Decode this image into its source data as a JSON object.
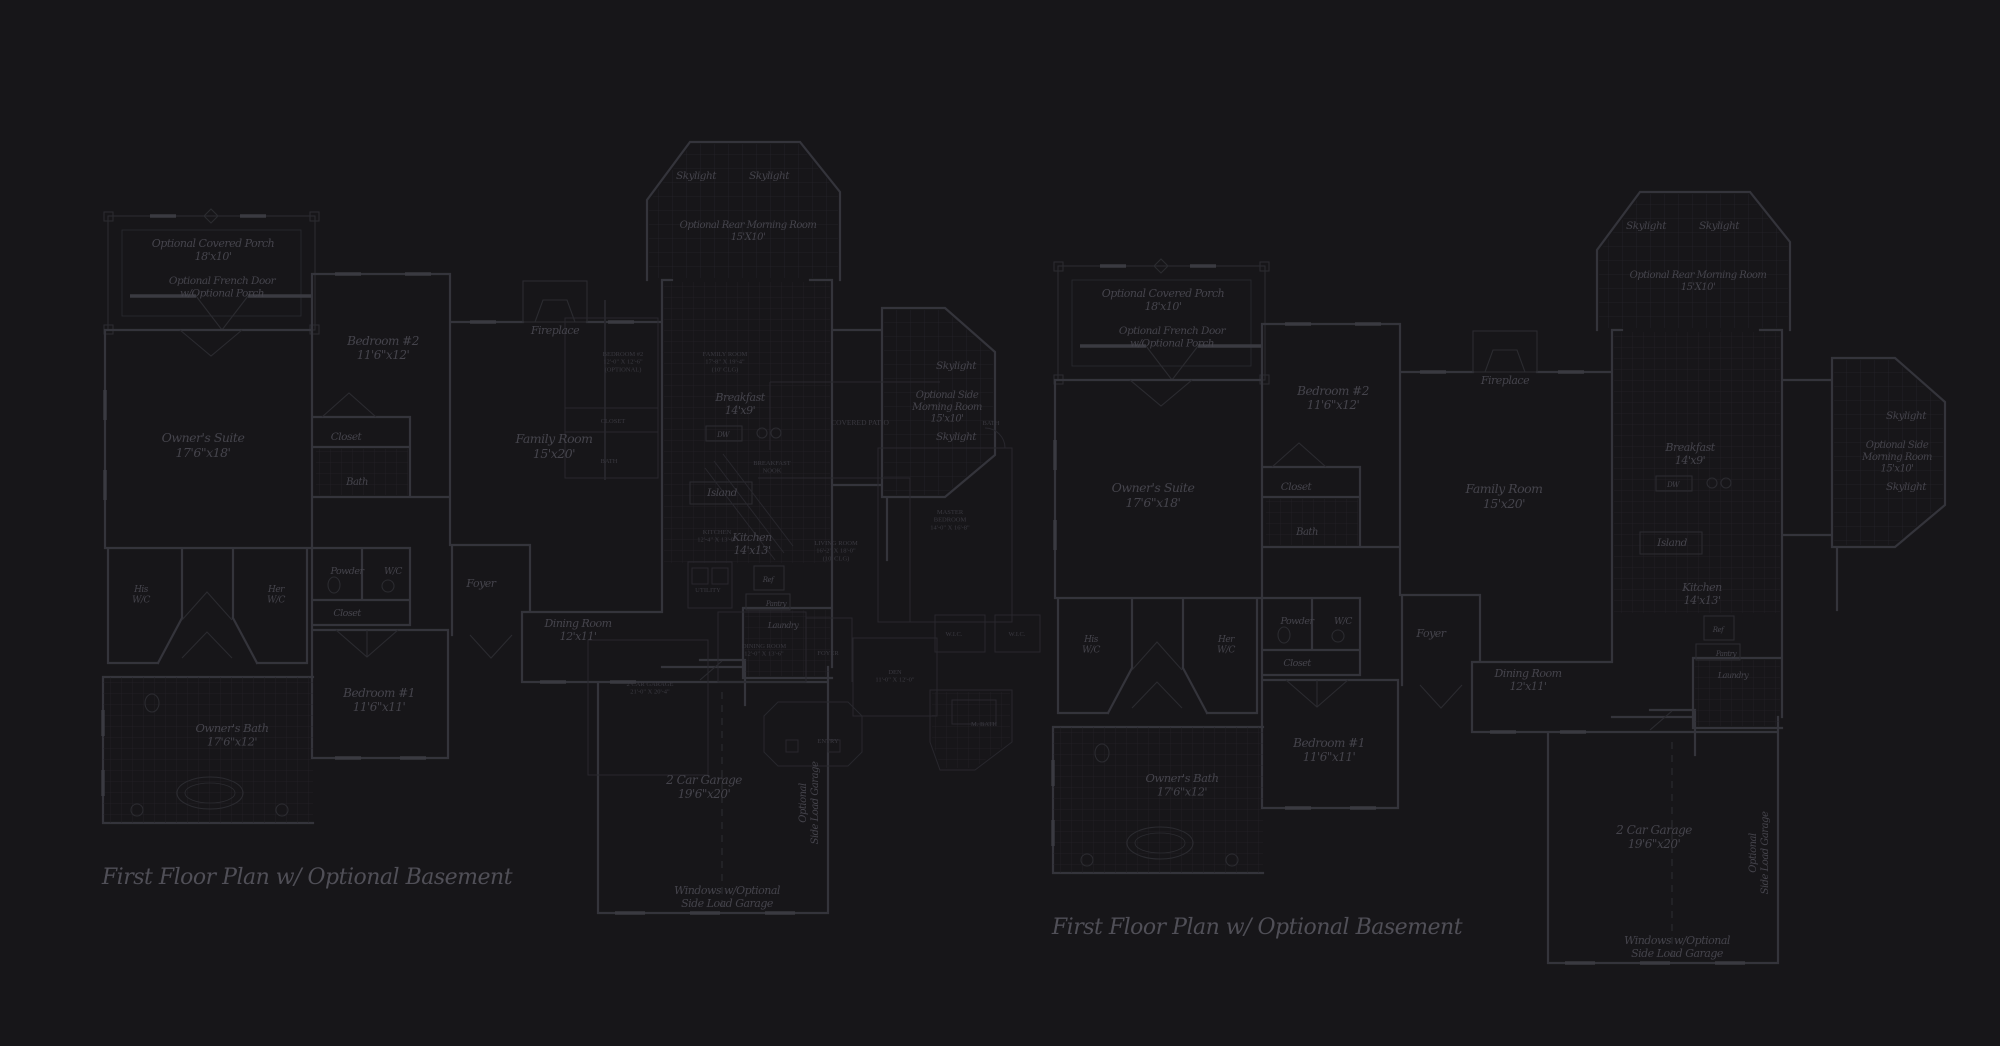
{
  "palette": {
    "background": "#171619",
    "wall": "#34343b",
    "wall_light": "#2b2b30",
    "grid": "#222126",
    "grid2": "#242329",
    "hatch": "#2f2e34",
    "label": "#45444c",
    "overlay_text": "#3a3940",
    "overlay_line": "#28272d",
    "caption": "#504f57",
    "tick": "#3a3a41"
  },
  "right_instance_offset": {
    "dx": 950,
    "dy": 50
  },
  "base_plan": {
    "caption": "First Floor Plan  w/ Optional Basement",
    "labels": [
      {
        "name": "porch-label",
        "lines": [
          "Optional Covered Porch",
          "18'x10'"
        ],
        "x": 213,
        "y": 247,
        "fs": 11
      },
      {
        "name": "french-door-label",
        "lines": [
          "Optional French Door",
          "w/Optional Porch"
        ],
        "x": 222,
        "y": 284,
        "fs": 10.5
      },
      {
        "name": "bedroom2-label",
        "lines": [
          "Bedroom #2",
          "11'6\"x12'"
        ],
        "x": 383,
        "y": 345,
        "fs": 12
      },
      {
        "name": "owners-suite-label",
        "lines": [
          "Owner's Suite",
          "17'6\"x18'"
        ],
        "x": 203,
        "y": 442,
        "fs": 12.5
      },
      {
        "name": "closet-bedroom2-label",
        "lines": [
          "Closet"
        ],
        "x": 346,
        "y": 440,
        "fs": 10.5
      },
      {
        "name": "bath-bedroom2-label",
        "lines": [
          "Bath"
        ],
        "x": 357,
        "y": 485,
        "fs": 10
      },
      {
        "name": "fireplace-label",
        "lines": [
          "Fireplace"
        ],
        "x": 555,
        "y": 334,
        "fs": 11
      },
      {
        "name": "skylight-rear-left-label",
        "lines": [
          "Skylight"
        ],
        "x": 696,
        "y": 179,
        "fs": 10.5
      },
      {
        "name": "skylight-rear-right-label",
        "lines": [
          "Skylight"
        ],
        "x": 769,
        "y": 179,
        "fs": 10.5
      },
      {
        "name": "rear-morning-room-label",
        "lines": [
          "Optional Rear Morning Room",
          "15'X10'"
        ],
        "x": 748,
        "y": 228,
        "fs": 10
      },
      {
        "name": "family-room-label",
        "lines": [
          "Family Room",
          "15'x20'"
        ],
        "x": 554,
        "y": 443,
        "fs": 12.5
      },
      {
        "name": "breakfast-label",
        "lines": [
          "Breakfast",
          "14'x9'"
        ],
        "x": 740,
        "y": 401,
        "fs": 11
      },
      {
        "name": "dw-label",
        "lines": [
          "DW"
        ],
        "x": 723,
        "y": 437,
        "fs": 7
      },
      {
        "name": "island-label",
        "lines": [
          "Island"
        ],
        "x": 722,
        "y": 496,
        "fs": 10.5
      },
      {
        "name": "kitchen-label",
        "lines": [
          "Kitchen",
          "14'x13'"
        ],
        "x": 752,
        "y": 541,
        "fs": 11
      },
      {
        "name": "ref-label",
        "lines": [
          "Ref"
        ],
        "x": 768,
        "y": 582,
        "fs": 7
      },
      {
        "name": "pantry-label",
        "lines": [
          "Pantry"
        ],
        "x": 776,
        "y": 606,
        "fs": 7
      },
      {
        "name": "laundry-label",
        "lines": [
          "Laundry"
        ],
        "x": 783,
        "y": 628,
        "fs": 8
      },
      {
        "name": "skylight-side-top-label",
        "lines": [
          "Skylight"
        ],
        "x": 956,
        "y": 369,
        "fs": 10.5
      },
      {
        "name": "side-morning-room-label",
        "lines": [
          "Optional Side",
          "Morning Room",
          "15'x10'"
        ],
        "x": 947,
        "y": 398,
        "fs": 10
      },
      {
        "name": "skylight-side-bottom-label",
        "lines": [
          "Skylight"
        ],
        "x": 956,
        "y": 440,
        "fs": 10.5
      },
      {
        "name": "his-wc-label",
        "lines": [
          "His",
          "W/C"
        ],
        "x": 141,
        "y": 592,
        "fs": 9
      },
      {
        "name": "her-wc-label",
        "lines": [
          "Her",
          "W/C"
        ],
        "x": 276,
        "y": 592,
        "fs": 9
      },
      {
        "name": "powder-label",
        "lines": [
          "Powder"
        ],
        "x": 347,
        "y": 574,
        "fs": 9.5
      },
      {
        "name": "wc-label",
        "lines": [
          "W/C"
        ],
        "x": 393,
        "y": 574,
        "fs": 9
      },
      {
        "name": "foyer-label",
        "lines": [
          "Foyer"
        ],
        "x": 481,
        "y": 587,
        "fs": 11
      },
      {
        "name": "closet-hall-label",
        "lines": [
          "Closet"
        ],
        "x": 347,
        "y": 616,
        "fs": 9.5
      },
      {
        "name": "dining-room-label",
        "lines": [
          "Dining Room",
          "12'x11'"
        ],
        "x": 578,
        "y": 627,
        "fs": 11
      },
      {
        "name": "bedroom1-label",
        "lines": [
          "Bedroom #1",
          "11'6\"x11'"
        ],
        "x": 379,
        "y": 697,
        "fs": 12
      },
      {
        "name": "owners-bath-label",
        "lines": [
          "Owner's Bath",
          "17'6\"x12'"
        ],
        "x": 232,
        "y": 732,
        "fs": 11.5
      },
      {
        "name": "garage-label",
        "lines": [
          "2 Car Garage",
          "19'6\"x20'"
        ],
        "x": 704,
        "y": 784,
        "fs": 12
      },
      {
        "name": "side-load-garage-label",
        "lines": [
          "Optional",
          "Side Load Garage"
        ],
        "x": 806,
        "y": 803,
        "fs": 10,
        "rot": -90
      },
      {
        "name": "windows-note-label",
        "lines": [
          "Windows w/Optional",
          "Side Load Garage"
        ],
        "x": 727,
        "y": 894,
        "fs": 11
      },
      {
        "name": "plan-caption",
        "lines": [
          "First Floor Plan  w/ Optional Basement"
        ],
        "x": 307,
        "y": 884,
        "fs": 22,
        "fill": "caption",
        "ls": -1
      }
    ]
  },
  "overlay_plan": {
    "labels": [
      {
        "name": "ovl-bedroom-label",
        "lines": [
          "BEDROOM #2",
          "12'-0\" X 12'-6\"",
          "(OPTIONAL)"
        ],
        "x": 623,
        "y": 356
      },
      {
        "name": "ovl-family-room-label",
        "lines": [
          "FAMILY ROOM",
          "17'-8\" X 19'-4\"",
          "(10' CLG)"
        ],
        "x": 725,
        "y": 356
      },
      {
        "name": "ovl-closet-label",
        "lines": [
          "CLOSET"
        ],
        "x": 613,
        "y": 423
      },
      {
        "name": "ovl-bath-label",
        "lines": [
          "BATH"
        ],
        "x": 609,
        "y": 463
      },
      {
        "name": "ovl-covered-patio-label",
        "lines": [
          "COVERED PATIO"
        ],
        "x": 860,
        "y": 425,
        "fs": 7.5
      },
      {
        "name": "ovl-breakfast-nook-label",
        "lines": [
          "BREAKFAST",
          "NOOK"
        ],
        "x": 772,
        "y": 465
      },
      {
        "name": "ovl-kitchen-label",
        "lines": [
          "KITCHEN",
          "12'-4\" X 13'-0\""
        ],
        "x": 717,
        "y": 534
      },
      {
        "name": "ovl-living-room-label",
        "lines": [
          "LIVING ROOM",
          "16'-2\" X 18'-0\"",
          "(10' CLG)"
        ],
        "x": 836,
        "y": 545
      },
      {
        "name": "ovl-master-bedroom-label",
        "lines": [
          "MASTER",
          "BEDROOM",
          "14'-0\" X 16'-8\""
        ],
        "x": 950,
        "y": 514
      },
      {
        "name": "ovl-master-bath-entry-label",
        "lines": [
          "BATH"
        ],
        "x": 991,
        "y": 425
      },
      {
        "name": "ovl-wic-left-label",
        "lines": [
          "W.I.C."
        ],
        "x": 954,
        "y": 636
      },
      {
        "name": "ovl-wic-right-label",
        "lines": [
          "W.I.C."
        ],
        "x": 1017,
        "y": 636
      },
      {
        "name": "ovl-master-bath-label",
        "lines": [
          "M. BATH"
        ],
        "x": 984,
        "y": 726
      },
      {
        "name": "ovl-den-label",
        "lines": [
          "DEN",
          "11'-0\" X 12'-0\""
        ],
        "x": 895,
        "y": 674
      },
      {
        "name": "ovl-dining-room-label",
        "lines": [
          "DINING ROOM",
          "12'-0\" X 13'-6\""
        ],
        "x": 764,
        "y": 648
      },
      {
        "name": "ovl-foyer-label",
        "lines": [
          "FOYER"
        ],
        "x": 828,
        "y": 655
      },
      {
        "name": "ovl-entry-label",
        "lines": [
          "ENTRY"
        ],
        "x": 828,
        "y": 743
      },
      {
        "name": "ovl-garage-label",
        "lines": [
          "2 CAR GARAGE",
          "21'-0\" X 20'-4\""
        ],
        "x": 650,
        "y": 686
      },
      {
        "name": "ovl-utility-label",
        "lines": [
          "UTILITY"
        ],
        "x": 708,
        "y": 592
      }
    ]
  }
}
